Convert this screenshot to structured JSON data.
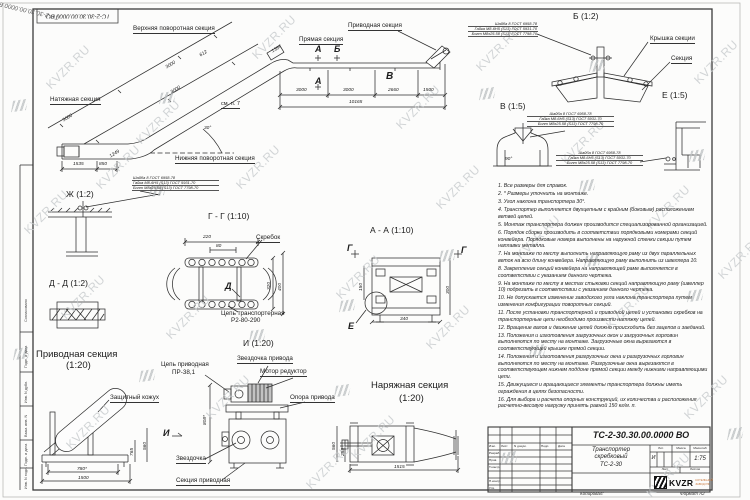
{
  "watermark": {
    "text": "KVZR.RU"
  },
  "corner_stamp": "ТС-2-30.30.00.0000 ВО",
  "diag_stamp": "ТС-2-30.30.00.0000 ВО",
  "general_view": {
    "labels": {
      "upper_turn": "Верхняя поворотная секция",
      "straight": "Прямая секция",
      "drive": "Приводная секция",
      "tension": "Натяжная секция",
      "lower_turn": "Нижняя поворотная секция",
      "see_note": "см. п. 7"
    },
    "marks": {
      "a_top": "А",
      "a_bot": "А",
      "b": "Б",
      "v": "В"
    },
    "dims": {
      "d1367": "1367",
      "d612": "612",
      "i3000a": "3000",
      "i3000b": "3000",
      "i3000c": "3000",
      "d1249": "1249",
      "angle": "30°",
      "d1535": "1535",
      "d850": "850",
      "h3000a": "3000",
      "h3000b": "3000",
      "d2660": "2660",
      "d1500": "1500",
      "total": "10165"
    }
  },
  "bolt_spec": {
    "line1": "Шайба 8 ГОСТ 6958-78",
    "line2": "Гайка М8-6Н5 (S13) ГОСТ 5931-70",
    "line3": "Болт М8х25.58 (S13) ГОСТ 7798-70"
  },
  "detail_b": {
    "title": "Б (1:2)",
    "cover": "Крышка секции",
    "section": "Секция"
  },
  "detail_v": {
    "title": "В (1:5)",
    "angle": "90°"
  },
  "detail_e": {
    "title": "Е (1:5)"
  },
  "detail_zh": {
    "title": "Ж (1:2)"
  },
  "section_gg": {
    "title": "Г - Г (1:10)",
    "scraper": "Скребок",
    "chain1": "Цепь транспортерная",
    "chain2": "Р2-80-290",
    "mark_d": "Д",
    "dims": {
      "d220": "220",
      "d80": "80",
      "d320": "320",
      "d400": "400"
    }
  },
  "section_aa": {
    "title": "А - А (1:10)",
    "mark_g_left": "Г",
    "mark_g_right": "Г",
    "mark_e": "Е",
    "dims": {
      "d150": "150",
      "d300": "300",
      "d340": "340"
    }
  },
  "section_dd": {
    "title": "Д - Д (1:2)"
  },
  "drive_section": {
    "title1": "Приводная секция",
    "title2": "(1:20)",
    "guard": "Защитный кожух",
    "dims": {
      "d780": "780*",
      "d1500": "1500",
      "d765": "765",
      "d560": "560"
    }
  },
  "view_i": {
    "title": "И (1:20)",
    "chain1": "Цепь приводная",
    "chain2": "ПР-38,1",
    "sprocket_drive": "Звездочка привода",
    "motor": "Мотор редуктор",
    "support": "Опора привода",
    "sprocket": "Звездочка",
    "section": "Секция приводная",
    "mark": "И",
    "dim808": "808*"
  },
  "tension_section": {
    "title1": "Наряжная секция",
    "title2": "(1:20)",
    "dims": {
      "d1515": "1515",
      "d560": "560",
      "d258": "258"
    }
  },
  "notes": [
    "1. Все размеры для справок.",
    "2. * Размеры уточнить на монтаже.",
    "3. Угол наклона транспортера 30°.",
    "4. Транспортер выполняется двухцепным с крайним (боковым) расположением ветвей цепей.",
    "5. Монтаж транспортера должен производится специализированной организацией.",
    "6. Порядок сборки производить в соответствии порядковыми номерами секций конвейера. Порядковые номера выполнены на наружной стенки секции путем наплавки металла.",
    "7. На монтаже по месту выполнить направляющую раму из двух параллельных веток на всю длину конвейера. Направляющую раму выполнить из швеллера 10.",
    "8. Закрепление секций конвейера на направляющей раме выполняется в соответствии с указанием данного чертежа.",
    "9. На монтаже по месту в местах стыковки секций направляющую раму (швеллер 10) подрезать в соответствии с указанием данного чертежа.",
    "10. Не допускается изменение заводского угла наклона транспортера путем изменения конфигурации поворотных секций.",
    "11. После установки транспортерной и приводной цепей и установки скребков на транспортерные цепи необходимо произвести натяжку цепей.",
    "12. Вращение валов и движение цепей должно происходить без зацепов и заеданий.",
    "13. Положения и изготовления загрузочных окон и загрузочных горловин выполняются по месту на монтаже. Загрузочные окна вырезаются в соответствующей крышке прямой секции.",
    "14. Положения и изготовления разгрузочных окна и разгрузочных горловин выполняются по месту на монтаже. Разгрузочные окна вырезаются в соответствующем нижнем поддоне прямой секции между нижними направляющими цепи.",
    "15. Движущиеся и вращающиеся элементы транспортера должны иметь ограждения в целях безопасности.",
    "16. Для выбора и расчета опорных конструкций, их количества и расположения расчетно-весовую нагрузку принять равной 150 кг/м. п."
  ],
  "title_block": {
    "doc_number": "ТС-2-30.30.00.0000  ВО",
    "name1": "Транспортер",
    "name2": "скребковый",
    "name3": "ТС-2-30",
    "lit_header": "Лит.",
    "mass_header": "Масса",
    "scale_header": "Масштаб",
    "lit": "И",
    "scale": "1:75",
    "sheet_header": "Лист",
    "sheets_header": "Листов",
    "col_izm": "Изм.",
    "col_list": "Лист",
    "col_doc": "N докум.",
    "col_sign": "Подп.",
    "col_date": "Дата",
    "row_razrab": "Разраб.",
    "row_prov": "Пров.",
    "row_tkontr": "Т.контр.",
    "row_nkontr": "Н.контр.",
    "row_utv": "Утв.",
    "logo": "KVZR",
    "logo_sub1": "КОТЕЛЬНЫЙ",
    "logo_sub2": "ЗАВОД РФ",
    "copied": "Копировал:",
    "format": "Формат А2"
  },
  "frame_labels": {
    "soglasovano": "Согласовано",
    "podp1": "Подп. и дата",
    "inv_dubl": "Инв. N дубл.",
    "vzam": "Взам. инв. N",
    "podp2": "Подп. и дата",
    "inv_podl": "Инв. N подл."
  }
}
